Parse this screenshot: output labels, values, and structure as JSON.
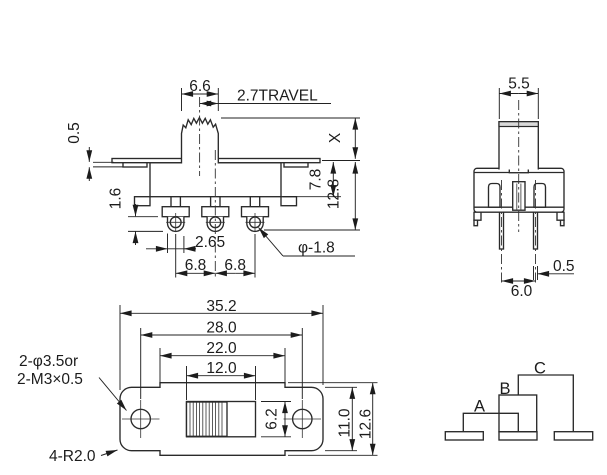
{
  "front_view": {
    "knob_width": "6.6",
    "travel_label": "2.7TRAVEL",
    "flange_thickness": "0.5",
    "step_height": "1.6",
    "terminal_width": "2.65",
    "terminal_pitch_left": "6.8",
    "terminal_pitch_right": "6.8",
    "knob_height": "X",
    "body_depth": "7.8",
    "overall_depth": "12.8",
    "terminal_hole": "φ-1.8"
  },
  "side_view": {
    "knob_width": "5.5",
    "pin_thickness": "0.5",
    "pin_spacing": "6.0"
  },
  "top_view": {
    "overall_length": "35.2",
    "mounting_hole_pitch": "28.0",
    "body_length": "22.0",
    "slot_length": "12.0",
    "slot_width": "6.2",
    "plate_width": "11.0",
    "overall_width": "12.6",
    "hole_note_1": "2-φ3.5or",
    "hole_note_2": "2-M3×0.5",
    "corner_note": "4-R2.0"
  },
  "circuit": {
    "a": "A",
    "b": "B",
    "c": "C"
  }
}
